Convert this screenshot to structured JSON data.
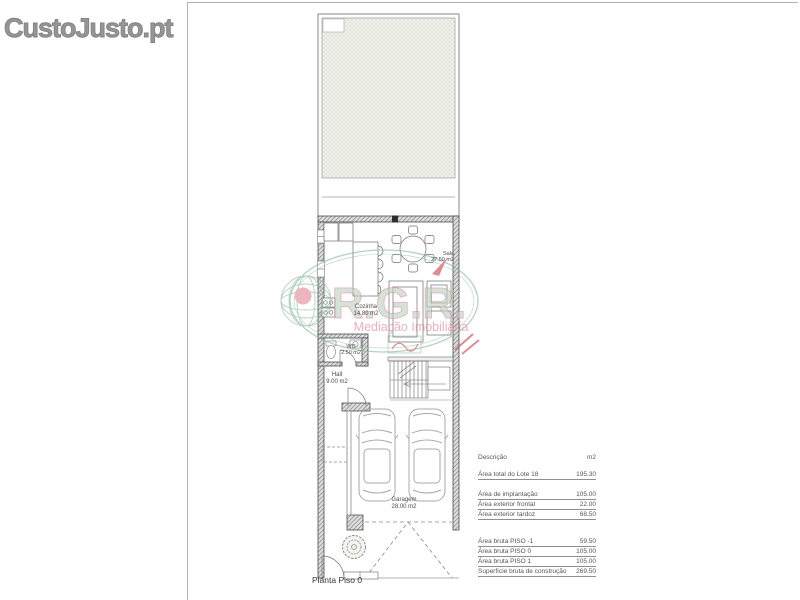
{
  "site": {
    "logo_text": "CustoJusto.pt"
  },
  "watermark": {
    "name": "R.G.R.",
    "tagline": "Mediação Imobiliária"
  },
  "plan": {
    "floor_title": "Planta Piso 0",
    "rooms": [
      {
        "name": "Sala",
        "area": "27.50 m2"
      },
      {
        "name": "Cozinha",
        "area": "14.80 m2"
      },
      {
        "name": "WC",
        "area": "2.50 m2"
      },
      {
        "name": "Hall",
        "area": "9.00 m2"
      },
      {
        "name": "Garagem",
        "area": "28.00 m2"
      }
    ]
  },
  "areas_table": {
    "header": {
      "description": "Descrição",
      "unit": "m2"
    },
    "rows": [
      {
        "label": "Área total do Lote 18",
        "value": "195.30"
      },
      {
        "label": "Área de implantação",
        "value": "105.00"
      },
      {
        "label": "Área exterior frontal",
        "value": "22.00"
      },
      {
        "label": "Área exterior tardoz",
        "value": "68.50"
      },
      {
        "label": "Área bruta PISO -1",
        "value": "59.50"
      },
      {
        "label": "Área bruta PISO 0",
        "value": "105.00"
      },
      {
        "label": "Área bruta PISO 1",
        "value": "105.00"
      },
      {
        "label": "Superfície bruta de construção",
        "value": "269.50"
      }
    ]
  },
  "colors": {
    "watermark_green": "#86b894",
    "watermark_red": "#cc4455",
    "logo_gray": "#959595"
  }
}
